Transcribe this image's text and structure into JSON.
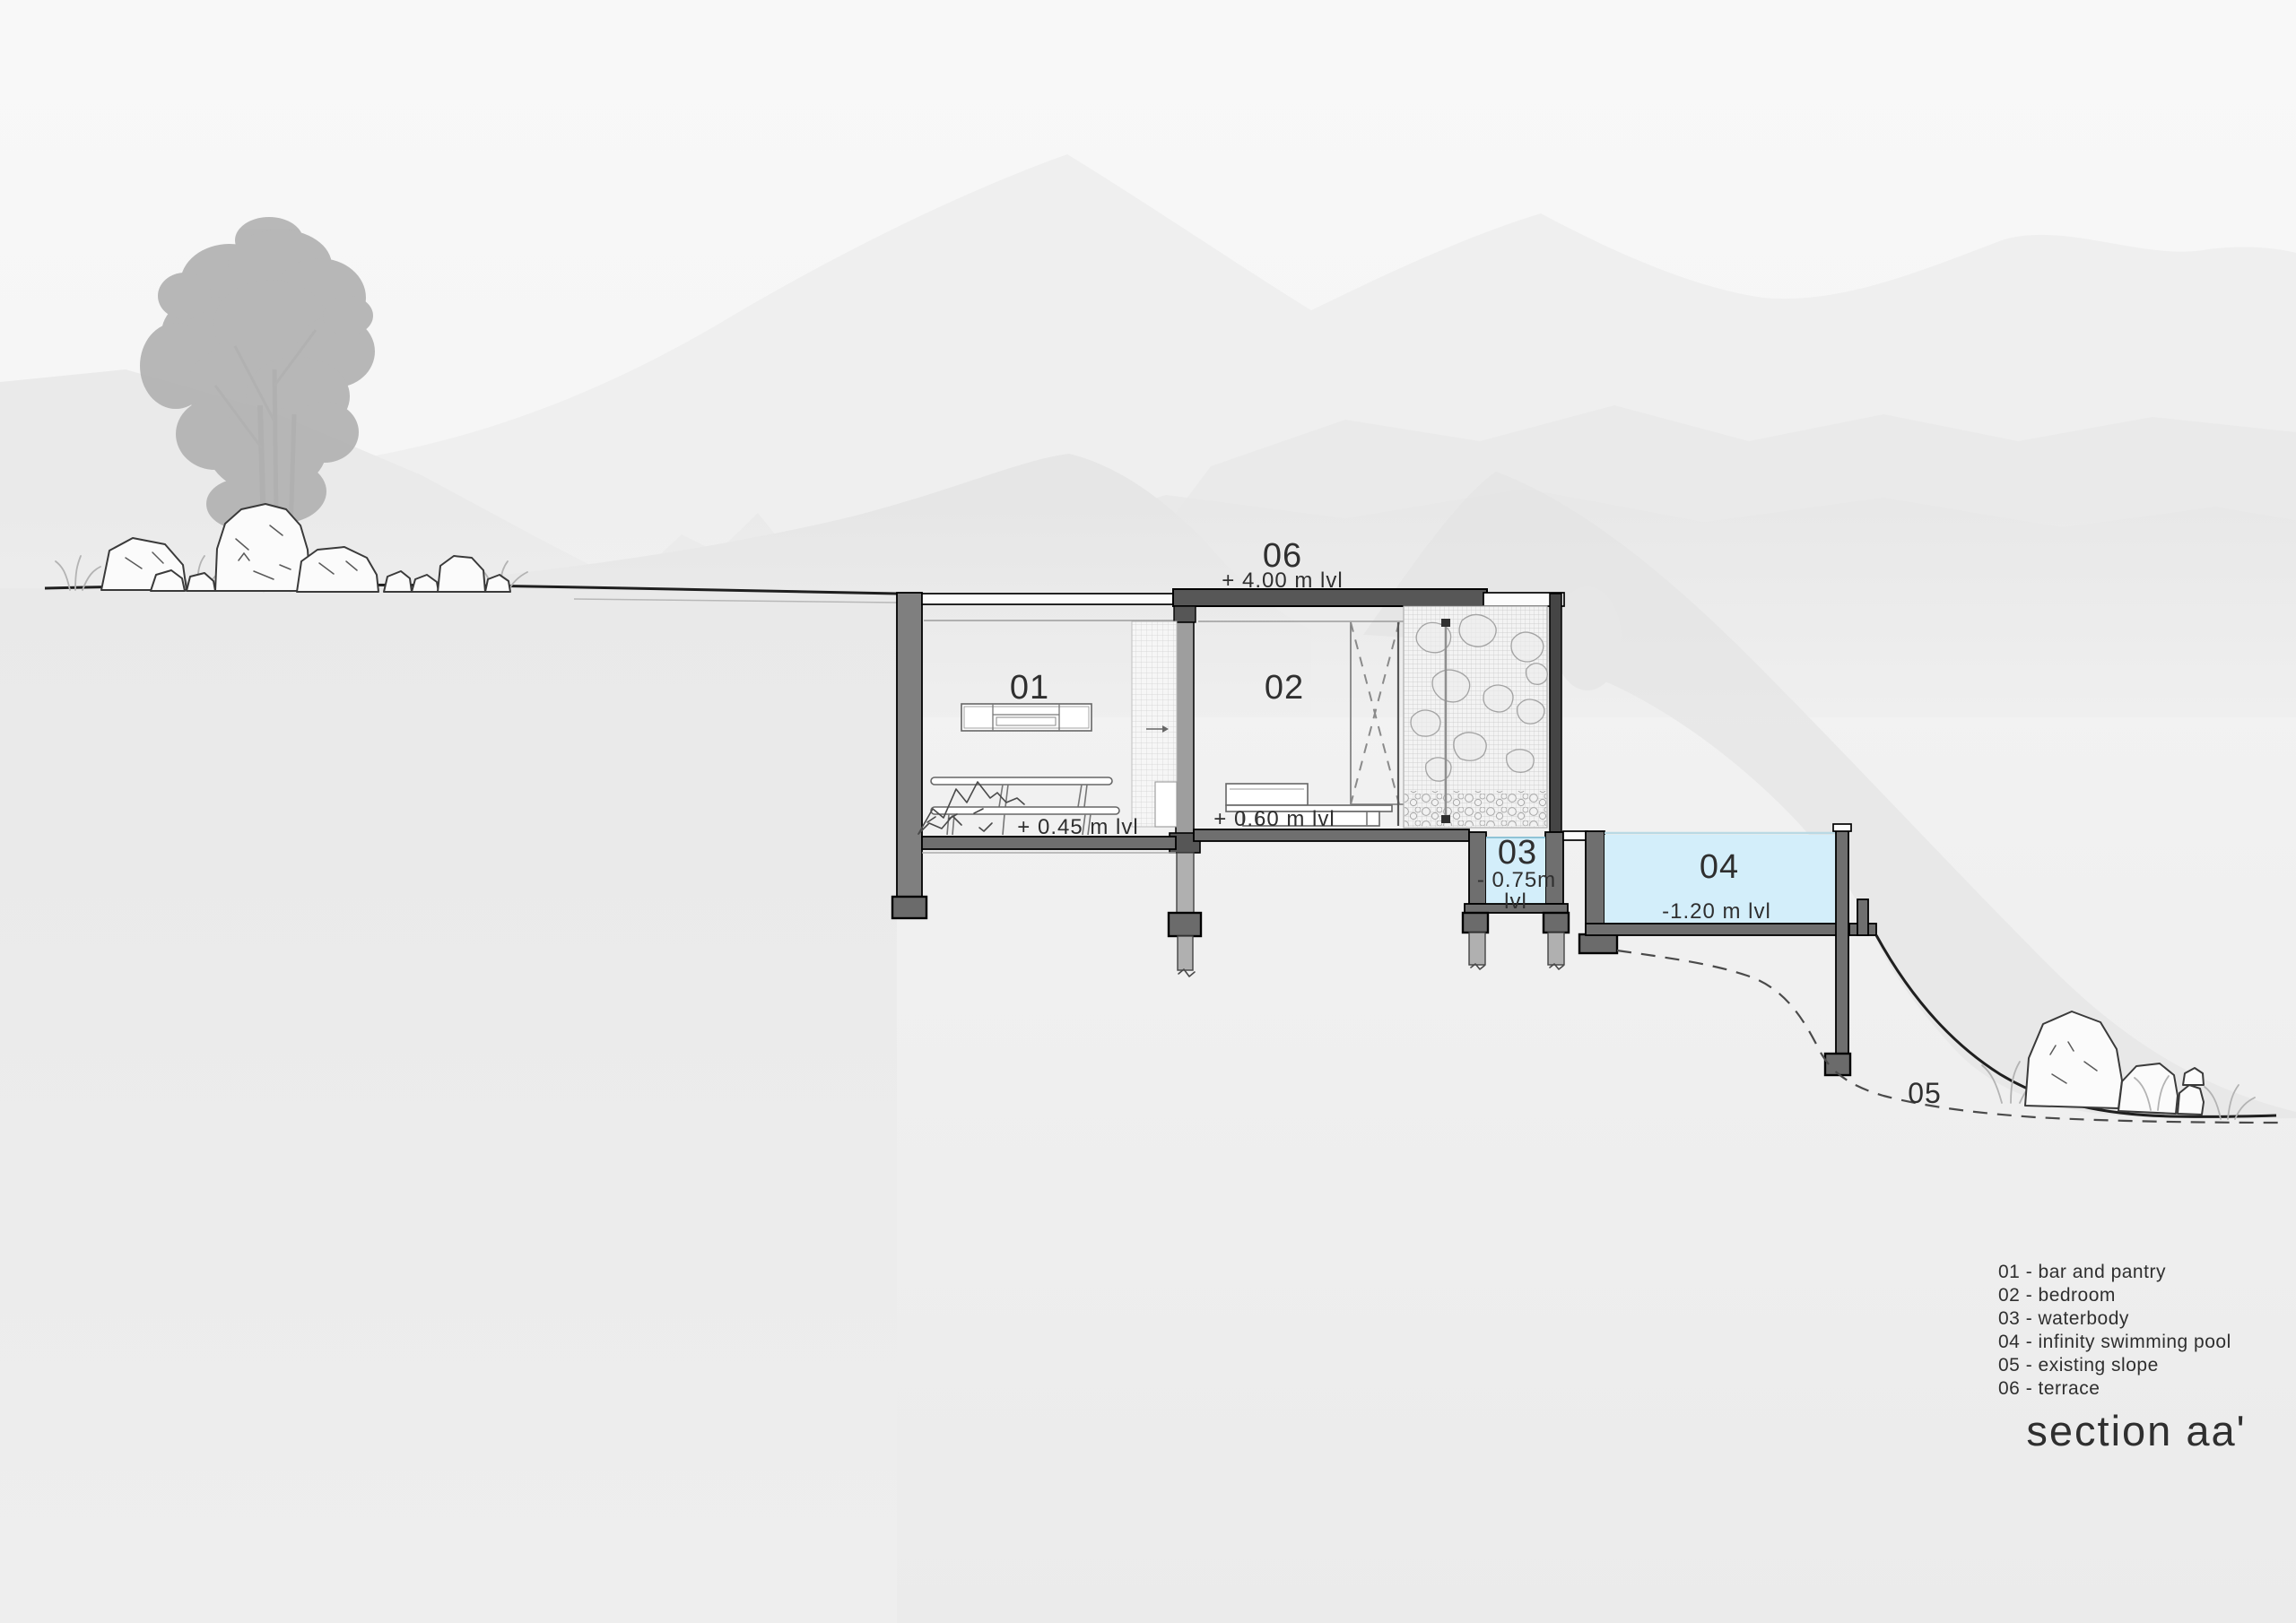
{
  "drawing": {
    "title": "section aa'",
    "labels": {
      "room01": "01",
      "room02": "02",
      "waterbody": "03",
      "pool": "04",
      "slope": "05",
      "terrace": "06"
    },
    "levels": {
      "terrace": "+ 4.00 m lvl",
      "room01": "+ 0.45 m lvl",
      "room02": "+ 0.60 m lvl",
      "waterbody_value": "- 0.75m",
      "waterbody_unit": "lvl",
      "pool": "-1.20 m lvl"
    },
    "legend": {
      "items": [
        "01 - bar and pantry",
        "02 - bedroom",
        "03 - waterbody",
        "04 - infinity swimming pool",
        "05 - existing slope",
        "06 - terrace"
      ]
    },
    "colors": {
      "text": "#2f2f2f",
      "water": "#d3eefa",
      "slab_dark": "#575757",
      "wall_gray": "#7f7f7f",
      "wall_light": "#9e9e9e",
      "footing": "#6b6b6b",
      "wall_black": "#454545",
      "tree": "#b2b2b2",
      "mountain_far": "#efefef",
      "mountain_mid": "#e9e9e9",
      "hill_near": "#e6e6e6",
      "hill_dark": "#e2e2e2",
      "earth": "#eaeaea",
      "sky_top": "#f7f7f7",
      "ground_bottom": "#ededed"
    }
  }
}
